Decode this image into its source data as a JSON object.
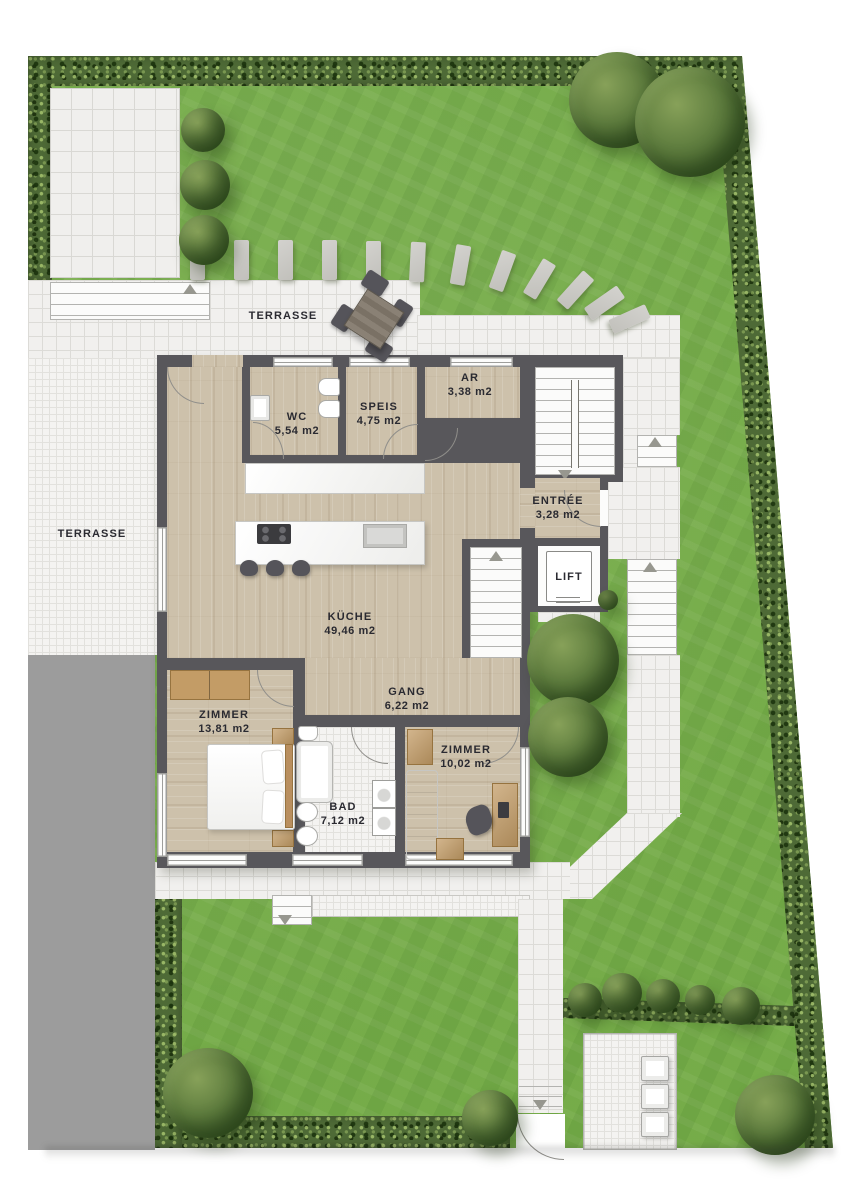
{
  "labels": {
    "terrace_north": "TERRASSE",
    "terrace_west": "TERRASSE"
  },
  "rooms": {
    "wc": {
      "name": "WC",
      "area": "5,54 m2"
    },
    "speis": {
      "name": "SPEIS",
      "area": "4,75 m2"
    },
    "ar": {
      "name": "AR",
      "area": "3,38 m2"
    },
    "entree": {
      "name": "ENTRÉE",
      "area": "3,28 m2"
    },
    "lift": {
      "name": "LIFT"
    },
    "kueche": {
      "name": "KÜCHE",
      "area": "49,46 m2"
    },
    "gang": {
      "name": "GANG",
      "area": "6,22 m2"
    },
    "zimmer_1": {
      "name": "ZIMMER",
      "area": "13,81 m2"
    },
    "zimmer_2": {
      "name": "ZIMMER",
      "area": "10,02 m2"
    },
    "bad": {
      "name": "BAD",
      "area": "7,12 m2"
    }
  },
  "colors": {
    "grass": "#74ab48",
    "hedge": "#4e6a36",
    "tile": "#f1f0ee",
    "tile_line": "#dcdbd7",
    "wood_floor": "#cdc1ab",
    "wall": "#58575b",
    "driveway": "#9c9c9c",
    "furniture_wood": "#c39c66",
    "fixture_white": "#ffffff",
    "label_text": "#2a2a31"
  }
}
